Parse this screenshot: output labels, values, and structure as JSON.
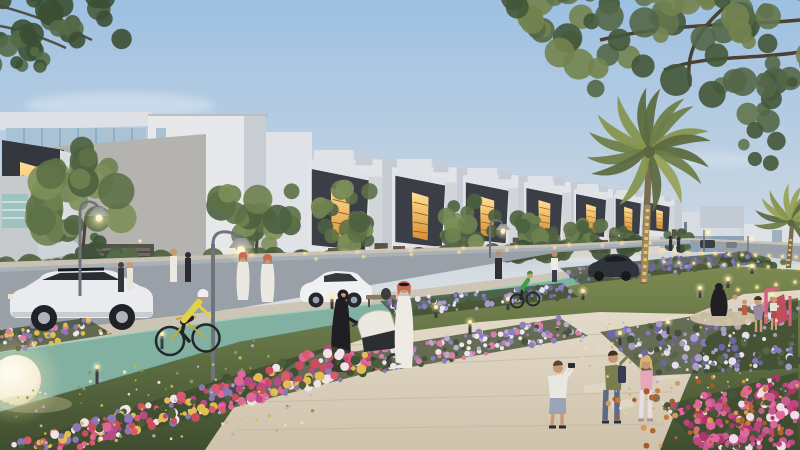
{
  "scene": "residential-community-park-dusk-architectural-render",
  "palette": {
    "skyTop": "#9dc0e2",
    "skyMid": "#bfd1e2",
    "skyHorizon": "#dcdfe1",
    "cloud": "#b9bcc2",
    "white1": "#e7e8ea",
    "white2": "#e2e4e7",
    "white3": "#dfe2e6",
    "shade1": "#c8cdd4",
    "shade2": "#c6ccd3",
    "concrete": "#b5b3af",
    "charcoal": "#34373e",
    "charcoal2": "#3b3e46",
    "amberHi": "#ffdf96",
    "amberLo": "#d98f2e",
    "glass": "#a9c2d4",
    "tealWindow": "#9ec2c0",
    "asphalt": "#99a0a8",
    "sidewalk": "#c8c2b4",
    "buffer": "#cdc6b7",
    "cyclePath": "#83b1a1",
    "cycleEdge": "#a6ccba",
    "plazaHi": "#e3dac9",
    "plazaLo": "#cfc2ab",
    "stone": "#e0d6c4",
    "grassHi": "#7d8a52",
    "grassMid": "#627244",
    "grassLo": "#3e4d2e",
    "trunk": "#4c4134",
    "palmTrunk": "#7b6b52",
    "goldLight": "#ecc46e",
    "lampMetal": "#6f747c",
    "lampShade": "#8b9098",
    "bulb": "#fff3cf",
    "bollard": "#3a3e42",
    "glowCore": "#ffe9b0",
    "suv": "#e9ebee",
    "sedan": "#eef0f2",
    "darkCar": "#2f343a",
    "carGlass": "#2a2e34",
    "thobe": "#eeebe4",
    "ghutraRed": "#c96a55",
    "abaya": "#201e22",
    "skin": "#c49a74",
    "jerseyYellow": "#e3d049",
    "jerseyGreen": "#3f9d4c",
    "oliveTee": "#7a7d4e",
    "pinkTop": "#e8a7b8",
    "jeans": "#5c6b85",
    "sphereLamp": "#f9f4e3",
    "playPink": "#d6607c",
    "playRed": "#bf4f5c",
    "sand": "#d3c6a9"
  },
  "clusters": [
    {
      "id": "tree-1",
      "layer": "mid",
      "cx": 85,
      "cy": 196,
      "rx": 54,
      "ry": 48,
      "count": 30,
      "rmin": 9,
      "rmax": 19,
      "seed": 11,
      "colors": [
        "#4d6140",
        "#5d7147",
        "#6e8150",
        "#7d8f58"
      ],
      "trunk": [
        82,
        258,
        86,
        216
      ]
    },
    {
      "id": "tree-2",
      "layer": "mid",
      "cx": 258,
      "cy": 212,
      "rx": 42,
      "ry": 36,
      "count": 24,
      "rmin": 7,
      "rmax": 15,
      "seed": 12,
      "colors": [
        "#4d6140",
        "#5d7147",
        "#6e8150",
        "#7d8f58"
      ],
      "trunk": [
        256,
        254,
        258,
        228
      ]
    },
    {
      "id": "tree-3",
      "layer": "mid",
      "cx": 352,
      "cy": 217,
      "rx": 36,
      "ry": 30,
      "count": 22,
      "rmin": 6,
      "rmax": 12,
      "seed": 13,
      "colors": [
        "#4d6140",
        "#5d7147",
        "#6e8150",
        "#7d8f58"
      ],
      "trunk": [
        350,
        252,
        352,
        230
      ]
    },
    {
      "id": "tree-4",
      "layer": "mid",
      "cx": 470,
      "cy": 225,
      "rx": 29,
      "ry": 24,
      "count": 20,
      "rmin": 5,
      "rmax": 10,
      "seed": 14,
      "colors": [
        "#4d6140",
        "#5d7147",
        "#6e8150",
        "#7d8f58"
      ],
      "trunk": [
        468,
        248,
        470,
        233
      ]
    },
    {
      "id": "tree-5",
      "layer": "mid",
      "cx": 533,
      "cy": 229,
      "rx": 24,
      "ry": 20,
      "count": 17,
      "rmin": 4,
      "rmax": 9,
      "seed": 15,
      "colors": [
        "#4d6140",
        "#5d7147",
        "#6e8150"
      ],
      "trunk": [
        531,
        248,
        533,
        236
      ]
    },
    {
      "id": "tree-6",
      "layer": "mid",
      "cx": 586,
      "cy": 233,
      "rx": 20,
      "ry": 16,
      "count": 15,
      "rmin": 4,
      "rmax": 8,
      "seed": 16,
      "colors": [
        "#4d6140",
        "#5d7147",
        "#6e8150"
      ],
      "trunk": [
        585,
        247,
        586,
        238
      ]
    },
    {
      "id": "tree-7",
      "layer": "mid",
      "cx": 626,
      "cy": 236,
      "rx": 16,
      "ry": 13,
      "count": 13,
      "rmin": 3,
      "rmax": 7,
      "seed": 17,
      "colors": [
        "#4d6140",
        "#5d7147",
        "#6e8150"
      ]
    },
    {
      "id": "tree-8",
      "layer": "mid",
      "cx": 678,
      "cy": 241,
      "rx": 14,
      "ry": 11,
      "count": 12,
      "rmin": 3,
      "rmax": 6,
      "seed": 18,
      "colors": [
        "#3e5138",
        "#495f40",
        "#576c46"
      ]
    },
    {
      "id": "bamboo-hedge",
      "layer": "mid",
      "cx": 112,
      "cy": 256,
      "rx": 32,
      "ry": 26,
      "count": 22,
      "rmin": 4,
      "rmax": 9,
      "seed": 19,
      "colors": [
        "#3e5138",
        "#495f40",
        "#576c46"
      ]
    },
    {
      "id": "hedge-left",
      "layer": "mid",
      "band": [
        0,
        268,
        310,
        260
      ],
      "count": 34,
      "rmin": 6,
      "rmax": 13,
      "seed": 20,
      "colors": [
        "#3f5036",
        "#4a5c3d",
        "#566845"
      ]
    },
    {
      "id": "hedge-right",
      "layer": "mid",
      "band": [
        312,
        262,
        658,
        246
      ],
      "count": 40,
      "rmin": 5,
      "rmax": 11,
      "seed": 21,
      "colors": [
        "#3f5036",
        "#4a5c3d",
        "#566845"
      ]
    },
    {
      "id": "median-shrubs-right",
      "layer": "mid",
      "cx": 757,
      "cy": 262,
      "rx": 40,
      "ry": 10,
      "count": 18,
      "rmin": 3,
      "rmax": 7,
      "seed": 22,
      "colors": [
        "#3e5138",
        "#495f40",
        "#576c46"
      ]
    },
    {
      "id": "canopy-top-right",
      "layer": "overhang",
      "cx": 665,
      "cy": 28,
      "rx": 175,
      "ry": 70,
      "count": 70,
      "rmin": 7,
      "rmax": 16,
      "seed": 23,
      "colors": [
        "#445739",
        "#536748",
        "#62754e",
        "#73834f"
      ]
    },
    {
      "id": "canopy-top-right-2",
      "layer": "overhang",
      "cx": 783,
      "cy": 112,
      "rx": 58,
      "ry": 55,
      "count": 26,
      "rmin": 5,
      "rmax": 12,
      "seed": 24,
      "colors": [
        "#445739",
        "#536748",
        "#62754e"
      ]
    },
    {
      "id": "branch-top-left",
      "layer": "overhang",
      "cx": 30,
      "cy": 16,
      "rx": 115,
      "ry": 55,
      "count": 44,
      "rmin": 6,
      "rmax": 13,
      "seed": 25,
      "colors": [
        "#3c4f35",
        "#485c3e",
        "#556a47"
      ]
    },
    {
      "id": "branch-top-left-2",
      "layer": "overhang",
      "cx": 6,
      "cy": 60,
      "rx": 42,
      "ry": 32,
      "count": 16,
      "rmin": 4,
      "rmax": 9,
      "seed": 26,
      "colors": [
        "#3c4f35",
        "#485c3e",
        "#556a47"
      ]
    }
  ],
  "flower_beds": [
    {
      "id": "bed-far-lavender",
      "layer": "back",
      "quad": [
        [
          560,
          268
        ],
        [
          748,
          251
        ],
        [
          764,
          263
        ],
        [
          580,
          284
        ]
      ],
      "count": 110,
      "rmin": 1,
      "rmax": 2.6,
      "seed": 35,
      "foliage": true,
      "colors": [
        "#8377b8",
        "#9d92c6",
        "#6e66a2",
        "#506042"
      ]
    },
    {
      "id": "bed-near-lavender",
      "layer": "back",
      "quad": [
        [
          380,
          301
        ],
        [
          562,
          283
        ],
        [
          578,
          297
        ],
        [
          397,
          318
        ]
      ],
      "count": 100,
      "rmin": 1.2,
      "rmax": 3,
      "seed": 36,
      "foliage": true,
      "colors": [
        "#8a7ec0",
        "#a79bcc",
        "#7068a8",
        "#e8e2f0",
        "#4a593c"
      ]
    },
    {
      "id": "bed-mid-white-pink",
      "layer": "back",
      "quad": [
        [
          352,
          352
        ],
        [
          560,
          318
        ],
        [
          588,
          336
        ],
        [
          382,
          372
        ]
      ],
      "count": 150,
      "rmin": 1.5,
      "rmax": 3.5,
      "seed": 32,
      "foliage": true,
      "colors": [
        "#efe7ea",
        "#d97fa8",
        "#8d80bd",
        "#b8aecf",
        "#46563a"
      ]
    },
    {
      "id": "bed-right-lavender",
      "layer": "back",
      "quad": [
        [
          600,
          332
        ],
        [
          798,
          298
        ],
        [
          798,
          368
        ],
        [
          648,
          376
        ]
      ],
      "count": 190,
      "rmin": 1.5,
      "rmax": 4,
      "seed": 33,
      "foliage": true,
      "colors": [
        "#8578bd",
        "#6f66a6",
        "#a99cc9",
        "#e6e0ee",
        "#43523a",
        "#55664a"
      ]
    },
    {
      "id": "bed-left-median",
      "layer": "back",
      "quad": [
        [
          0,
          330
        ],
        [
          86,
          318
        ],
        [
          112,
          334
        ],
        [
          0,
          352
        ]
      ],
      "count": 70,
      "rmin": 1.5,
      "rmax": 3.2,
      "seed": 37,
      "foliage": true,
      "colors": [
        "#d97fa8",
        "#e2bd55",
        "#efe4e6",
        "#8d77b5",
        "#46563a"
      ]
    },
    {
      "id": "bed-foreground-left",
      "layer": "front",
      "quad": [
        [
          8,
          446
        ],
        [
          330,
          346
        ],
        [
          402,
          364
        ],
        [
          70,
          450
        ]
      ],
      "count": 300,
      "rmin": 2,
      "rmax": 5,
      "seed": 31,
      "foliage": true,
      "colors": [
        "#e0679c",
        "#c94f60",
        "#efe4e6",
        "#b8498a",
        "#e2bd55",
        "#d9596e",
        "#8d77b5",
        "#3f5232",
        "#4a5f3a"
      ]
    },
    {
      "id": "bed-bottom-right-pink",
      "layer": "front",
      "quad": [
        [
          662,
          406
        ],
        [
          798,
          372
        ],
        [
          798,
          450
        ],
        [
          704,
          450
        ]
      ],
      "count": 190,
      "rmin": 2,
      "rmax": 5,
      "seed": 34,
      "foliage": true,
      "colors": [
        "#e0679c",
        "#c2447f",
        "#ad3668",
        "#efdce6",
        "#cb5b93",
        "#47563b"
      ]
    },
    {
      "id": "fallen-leaves",
      "layer": "front",
      "quad": [
        [
          600,
          392
        ],
        [
          764,
          366
        ],
        [
          788,
          436
        ],
        [
          640,
          448
        ]
      ],
      "count": 55,
      "rmin": 1.5,
      "rmax": 3.2,
      "seed": 38,
      "foliage": false,
      "colors": [
        "#c9793a",
        "#b5642f",
        "#d89a55",
        "#a85a2c"
      ]
    },
    {
      "id": "grass-speckle-left",
      "layer": "speckle",
      "quad": [
        [
          0,
          392
        ],
        [
          250,
          336
        ],
        [
          350,
          430
        ],
        [
          30,
          450
        ]
      ],
      "count": 90,
      "rmin": 0.8,
      "rmax": 1.8,
      "seed": 39,
      "foliage": false,
      "colors": [
        "#cdb84f",
        "#e6ddc8",
        "#b9a7d8",
        "#8c9a5a"
      ]
    },
    {
      "id": "grass-speckle-right",
      "layer": "speckle",
      "quad": [
        [
          560,
          330
        ],
        [
          780,
          302
        ],
        [
          800,
          396
        ],
        [
          620,
          416
        ]
      ],
      "count": 70,
      "rmin": 0.7,
      "rmax": 1.5,
      "seed": 40,
      "foliage": false,
      "colors": [
        "#cdb84f",
        "#e6ddc8",
        "#b9a7d8"
      ]
    }
  ],
  "bollards": [
    {
      "x": 162,
      "y": 349,
      "h": 15
    },
    {
      "x": 97,
      "y": 384,
      "h": 17
    },
    {
      "x": 332,
      "y": 309,
      "h": 12
    },
    {
      "x": 389,
      "y": 333,
      "h": 12
    },
    {
      "x": 470,
      "y": 334,
      "h": 12
    },
    {
      "x": 620,
      "y": 345,
      "h": 12
    },
    {
      "x": 668,
      "y": 334,
      "h": 12
    },
    {
      "x": 700,
      "y": 298,
      "h": 10
    },
    {
      "x": 728,
      "y": 288,
      "h": 9
    },
    {
      "x": 752,
      "y": 274,
      "h": 8
    },
    {
      "x": 772,
      "y": 303,
      "h": 8
    },
    {
      "x": 583,
      "y": 300,
      "h": 9
    },
    {
      "x": 436,
      "y": 318,
      "h": 11
    },
    {
      "x": 508,
      "y": 310,
      "h": 11
    }
  ],
  "light_rows": [
    {
      "x0": 648,
      "y0": 251,
      "x1": 796,
      "y1": 257,
      "n": 12,
      "r": 1.6
    },
    {
      "x0": 664,
      "y0": 262,
      "x1": 798,
      "y1": 268,
      "n": 10,
      "r": 1.5
    },
    {
      "x0": 252,
      "y0": 255,
      "x1": 622,
      "y1": 243,
      "n": 8,
      "r": 1.4
    },
    {
      "x0": 316,
      "y0": 259,
      "x1": 650,
      "y1": 243,
      "n": 8,
      "r": 1.2
    },
    {
      "x0": 700,
      "y0": 295,
      "x1": 795,
      "y1": 282,
      "n": 6,
      "r": 1.6
    }
  ],
  "palms": [
    {
      "target": "palm-fronds-1",
      "cx": 649,
      "cy": 150,
      "scale": 1.0,
      "seed": 51,
      "fronds": 16
    },
    {
      "target": "palm-fronds-2",
      "cx": 791,
      "cy": 221,
      "scale": 0.6,
      "seed": 52,
      "fronds": 13
    }
  ],
  "townhouse_units": [
    {
      "x": 308,
      "y": 150,
      "s": 0.95
    },
    {
      "x": 392,
      "y": 159,
      "s": 0.83
    },
    {
      "x": 463,
      "y": 168,
      "s": 0.71
    },
    {
      "x": 524,
      "y": 176,
      "s": 0.6
    },
    {
      "x": 574,
      "y": 184,
      "s": 0.5
    },
    {
      "x": 614,
      "y": 190,
      "s": 0.42
    },
    {
      "x": 648,
      "y": 196,
      "s": 0.34
    }
  ]
}
